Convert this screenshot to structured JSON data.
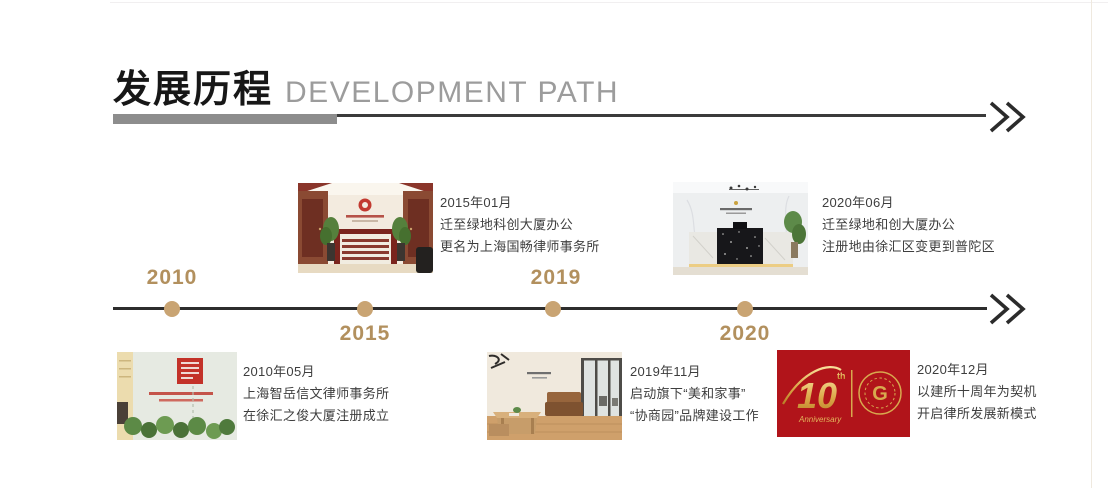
{
  "header": {
    "title_zh": "发展历程",
    "title_en": "DEVELOPMENT PATH"
  },
  "timeline": {
    "years": [
      {
        "label": "2010",
        "side": "above"
      },
      {
        "label": "2015",
        "side": "below"
      },
      {
        "label": "2019",
        "side": "above"
      },
      {
        "label": "2020",
        "side": "below"
      }
    ]
  },
  "milestones": [
    {
      "date": "2015年01月",
      "line1": "迁至绿地科创大厦办公",
      "line2": "更名为上海国畅律师事务所",
      "image": "office-reception-2015-photo"
    },
    {
      "date": "2020年06月",
      "line1": "迁至绿地和创大厦办公",
      "line2": "注册地由徐汇区变更到普陀区",
      "image": "office-reception-2020-photo"
    },
    {
      "date": "2010年05月",
      "line1": "上海智岳信文律师事务所",
      "line2": "在徐汇之俊大厦注册成立",
      "image": "founding-office-2010-photo"
    },
    {
      "date": "2019年11月",
      "line1": "启动旗下“美和家事”",
      "line2": "“协商园”品牌建设工作",
      "image": "office-interior-2019-photo"
    },
    {
      "date": "2020年12月",
      "line1": "以建所十周年为契机",
      "line2": "开启律所发展新模式",
      "image": "tenth-anniversary-banner"
    }
  ],
  "anniversary_banner": {
    "number": "10",
    "superscript": "th",
    "caption": "Anniversary",
    "seal_letter": "G"
  },
  "icons": {
    "header_arrow": "double-chevron-right",
    "timeline_arrow": "double-chevron-right"
  },
  "colors": {
    "accent_gold": "#b2905e",
    "dot_gold": "#c9a473",
    "timeline_dark": "#2d2d2d",
    "title_gray": "#9c9c9c",
    "rule_gray": "#8d8d8d",
    "banner_red": "#b5151b",
    "banner_gold": "#d8a94e",
    "text_dark": "#3e3e3e"
  }
}
